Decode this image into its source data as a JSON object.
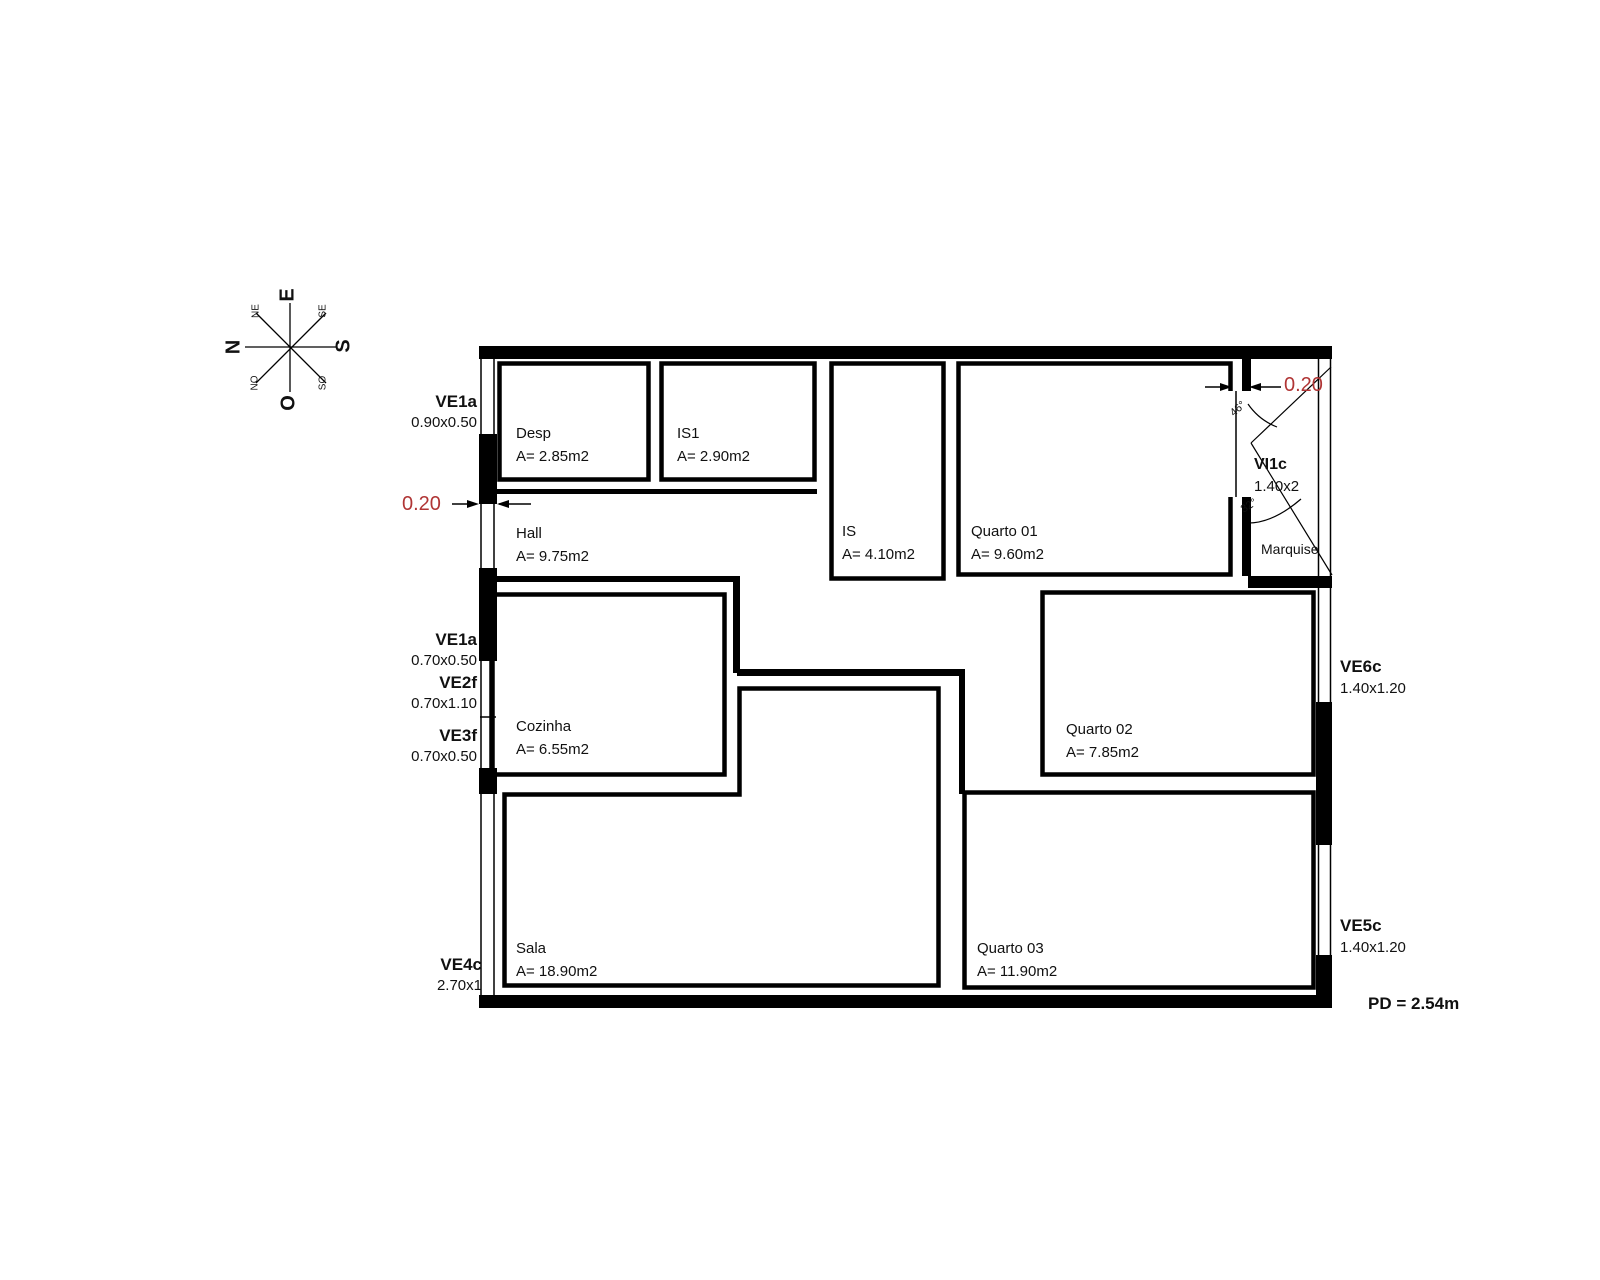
{
  "compass": {
    "n": "N",
    "s": "S",
    "e": "E",
    "o": "O",
    "ne": "NE",
    "se": "SE",
    "no": "NO",
    "so": "SO"
  },
  "rooms": {
    "desp": {
      "name": "Desp",
      "area": "A= 2.85m2"
    },
    "is1": {
      "name": "IS1",
      "area": "A= 2.90m2"
    },
    "is": {
      "name": "IS",
      "area": "A= 4.10m2"
    },
    "quarto01": {
      "name": "Quarto 01",
      "area": "A= 9.60m2"
    },
    "hall": {
      "name": "Hall",
      "area": "A= 9.75m2"
    },
    "cozinha": {
      "name": "Cozinha",
      "area": "A= 6.55m2"
    },
    "quarto02": {
      "name": "Quarto 02",
      "area": "A= 7.85m2"
    },
    "sala": {
      "name": "Sala",
      "area": "A= 18.90m2"
    },
    "quarto03": {
      "name": "Quarto 03",
      "area": "A= 11.90m2"
    },
    "marquise": {
      "name": "Marquise"
    }
  },
  "openings": {
    "ve1a_top": {
      "code": "VE1a",
      "size": "0.90x0.50"
    },
    "ve1a_mid": {
      "code": "VE1a",
      "size": "0.70x0.50"
    },
    "ve2f": {
      "code": "VE2f",
      "size": "0.70x1.10"
    },
    "ve3f": {
      "code": "VE3f",
      "size": "0.70x0.50"
    },
    "ve4c": {
      "code": "VE4c",
      "size": "2.70x1"
    },
    "ve6c": {
      "code": "VE6c",
      "size": "1.40x1.20"
    },
    "ve5c": {
      "code": "VE5c",
      "size": "1.40x1.20"
    },
    "vi1c": {
      "code": "VI1c",
      "size": "1.40x2"
    }
  },
  "dimensions": {
    "wall_thickness_left": "0.20",
    "wall_thickness_right": "0.20",
    "angle_upper": "46°",
    "angle_lower": "32°",
    "ceiling_height": "PD = 2.54m"
  },
  "colors": {
    "line": "#000000",
    "dim_red": "#b03535",
    "text": "#111111"
  }
}
